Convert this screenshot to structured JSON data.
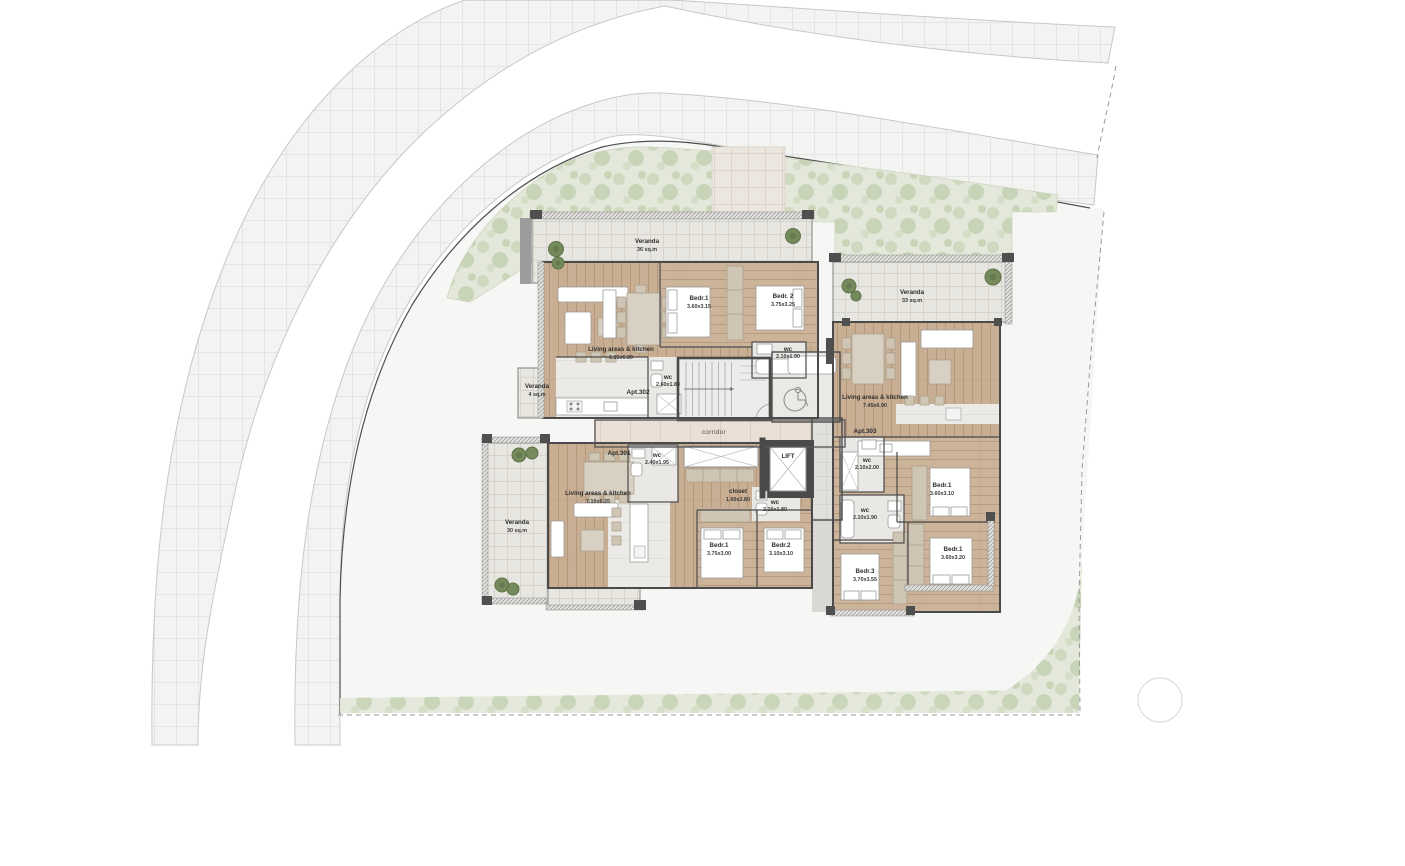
{
  "plan": {
    "common": {
      "corridor_label": "corridor",
      "lift_label": "LIFT"
    },
    "apt301": {
      "label": "Apt.301",
      "living_name": "Living areas & kitchen",
      "living_size": "7.10x6.25",
      "veranda_name": "Veranda",
      "veranda_size": "30 sq.m",
      "wc1_name": "wc",
      "wc1_size": "2.40x1.95",
      "wc2_name": "wc",
      "wc2_size": "2.15x1.80",
      "closet_name": "closet",
      "closet_size": "1.60x2.80",
      "bedr1_name": "Bedr.1",
      "bedr1_size": "3.75x3.00",
      "bedr2_name": "Bedr.2",
      "bedr2_size": "3.10x3.10"
    },
    "apt302": {
      "label": "Apt.302",
      "living_name": "Living areas & kitchen",
      "living_size": "6.15x6.80",
      "veranda_main_name": "Veranda",
      "veranda_main_size": "36 sq.m",
      "veranda_small_name": "Veranda",
      "veranda_small_size": "4 sq.m",
      "wc1_name": "wc",
      "wc1_size": "2.60x1.80",
      "wc2_name": "wc",
      "wc2_size": "2.10x1.90",
      "bedr1_name": "Bedr.1",
      "bedr1_size": "3.60x3.15",
      "bedr2_name": "Bedr. 2",
      "bedr2_size": "3.75x3.25"
    },
    "apt303": {
      "label": "Apt.303",
      "living_name": "Living areas & kitchen",
      "living_size": "7.45x6.90",
      "veranda_name": "Veranda",
      "veranda_size": "33 sq.m",
      "wc1_name": "wc",
      "wc1_size": "2.10x2.00",
      "wc2_name": "wc",
      "wc2_size": "2.10x1.90",
      "bedr1_name": "Bedr.1",
      "bedr1_size": "3.60x3.10",
      "bedr2_name": "Bedr.1",
      "bedr2_size": "3.60x3.20",
      "bedr3_name": "Bedr.3",
      "bedr3_size": "3.70x3.55"
    },
    "colors": {
      "wood": "#c8ae93",
      "veranda_tile": "#e8e6e1",
      "vegetation": "#e3e8da",
      "wall": "#4a4a4a",
      "road": "#f3f3f2",
      "tree": "#6f8757"
    }
  }
}
